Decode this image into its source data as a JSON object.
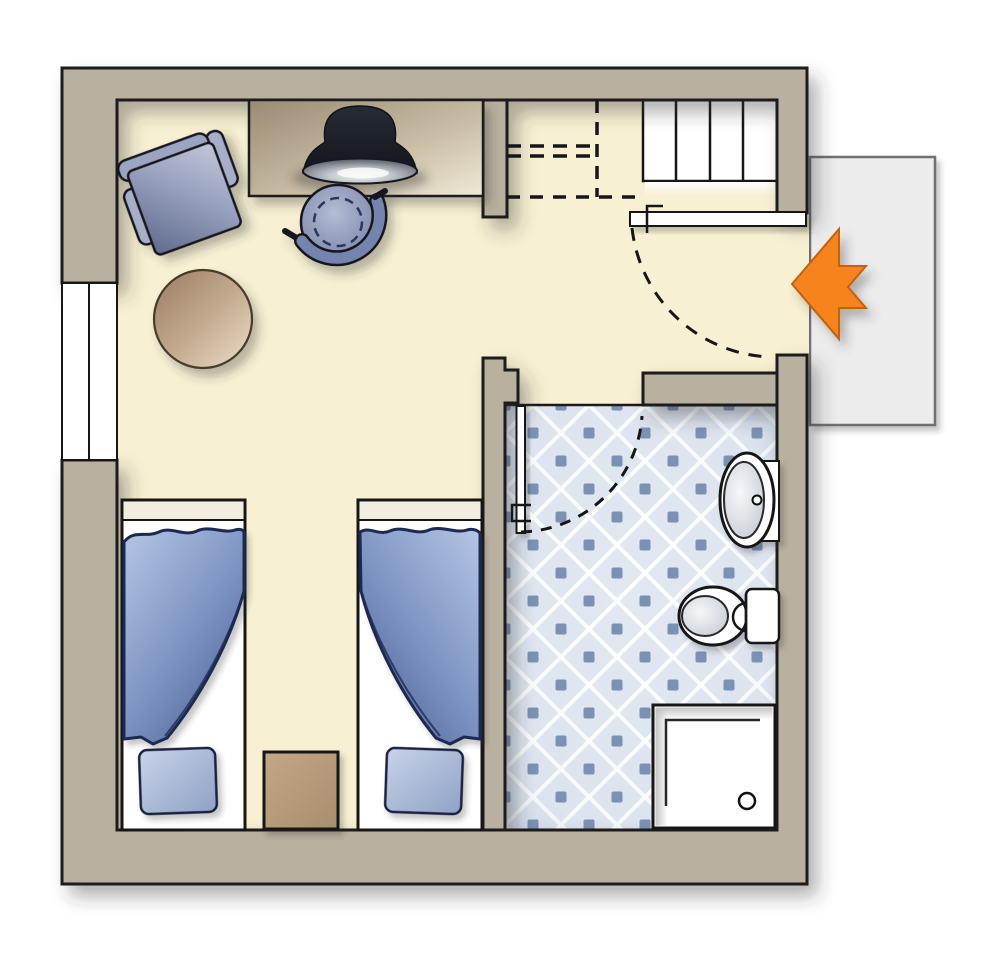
{
  "palette": {
    "canvas": "#ffffff",
    "wall_fill": "#b9b1a0",
    "wall_outline": "#1c1c1c",
    "floor_fill": "#f7f0d2",
    "tile_base": "#e1e8f2",
    "tile_line": "#ffffff",
    "tile_dot": "#7b90b2",
    "fixture_white": "#ffffff",
    "line_dark": "#161616",
    "landing_fill": "#ececec",
    "landing_border": "#6f6f6f",
    "arrow_fill": "#f6831d",
    "arrow_outline": "#c2620a",
    "duvet_light": "#b6c5e4",
    "duvet_mid": "#7e95c3",
    "duvet_dark": "#506399",
    "duvet_outline": "#1e2b52",
    "pillow_light": "#c9d3e8",
    "pillow_dark": "#8fa1c5",
    "chair_blue_light": "#c2c8d9",
    "chair_blue_mid": "#97a0bd",
    "chair_blue_dark": "#606a8d",
    "wood_light": "#ecdfcc",
    "wood_mid": "#c6ad92",
    "wood_dark": "#997c60",
    "desk_dark": "#9a8b73",
    "desk_mid": "#cbbfa7",
    "desk_light": "#f0e9d8",
    "lamp_dome_dark": "#14161c",
    "lamp_dome_mid": "#262b35",
    "lamp_rim_light": "#f4f5f6",
    "lamp_rim_dark": "#41454e",
    "basin_light": "#f6f7f8",
    "basin_dark": "#c3c9d2",
    "nightstand_light": "#c2a887",
    "nightstand_dark": "#a98e6c"
  },
  "plan": {
    "type": "floor-plan",
    "rooms": [
      "main-room",
      "entrance-area",
      "bathroom"
    ],
    "exterior": [
      "entrance-landing",
      "entrance-arrow"
    ],
    "furniture": [
      "armchair",
      "side-table",
      "desk",
      "desk-lamp",
      "desk-chair",
      "bed-left",
      "bed-right",
      "pillow-left",
      "pillow-right",
      "nightstand"
    ],
    "fixtures": [
      "window",
      "staircase",
      "entrance-door",
      "closet-dashed-outline",
      "bathroom-door",
      "sink",
      "toilet",
      "shower"
    ],
    "counts": {
      "beds": 2,
      "stair_treads": 4
    },
    "entrance_arrow_direction": "left"
  }
}
